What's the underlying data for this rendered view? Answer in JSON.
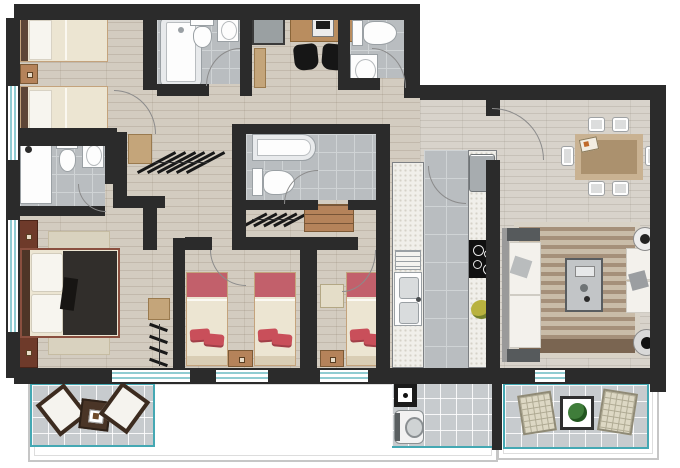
{
  "meta": {
    "title": "apartment-floor-plan",
    "canvas_w": 680,
    "canvas_h": 468
  },
  "palette": {
    "wall": "#2b2b2b",
    "wood": "#d3ccc0",
    "woodRight": "#d8d3cb",
    "tile": "#b9bdc0",
    "tileLine": "#cfd3d5",
    "shaft": "#9aa0a2",
    "balconyTile": "#c7cbce",
    "teal": "#44a8b3",
    "terrace": "#ffffff",
    "terraceEdge": "#c6c6c6",
    "fixtureWhite": "#fdfdfd",
    "fixtureEdge": "#9aa0a4",
    "counter": "#f0efea",
    "counterDot": "#d5d2c8",
    "appliance": "#a7acaf",
    "cooktop": "#101010",
    "bedCream": "#ece5d2",
    "bedFrame": "#c4a37c",
    "pillowWhite": "#f7f5ef",
    "headboardDark": "#5d4536",
    "pinkHeadboard": "#c2606b",
    "redBlanket": "#c94f5a",
    "duvetDark": "#312e2b",
    "mahogany": "#6e3a2a",
    "rugBeige": "#d9d2bf",
    "rugStripeA": "#a5907a",
    "rugStripeB": "#c9bca8",
    "rugDark": "#7a6551",
    "rugEdge": "#d8d2c6",
    "sofaWhite": "#f3f1ec",
    "sofaGrey": "#565a5c",
    "sofaBack": "#9a9a9a",
    "woodDesk": "#b98d5f",
    "woodShelf": "#c4a57a",
    "woodDresser": "#b5835a",
    "chairBlack": "#161616",
    "diningTable": "#c9b292",
    "diningTop": "#ab916e",
    "chairGrey": "#dcdddd",
    "chairEdge": "#9fa2a4",
    "wicker": "#ddd8c4",
    "wickerLine": "#b0ab94",
    "plant": "#3f7d3a",
    "bowl": "#b9b23f",
    "doorArc": "#8b8b8b",
    "glass": "#8fccd2"
  },
  "inventory": {
    "rooms": [
      "twin-bedroom",
      "bathroom-with-tub",
      "study-nook",
      "guest-bathroom",
      "ensuite-bathroom",
      "walk-in-closet",
      "master-bedroom",
      "kids-bedroom-1",
      "kids-bedroom-2",
      "central-bathroom",
      "galley-kitchen",
      "dining-room",
      "living-room",
      "master-balcony-patio",
      "service-balcony-laundry",
      "living-balcony",
      "terrace"
    ],
    "fixtures": [
      "bathtub",
      "shower",
      "toilet-x4",
      "washbasin-x4",
      "kitchen-sink",
      "cooktop-4-burner",
      "fridge",
      "washing-machine",
      "laundry-sink"
    ],
    "furniture": [
      "twin-bed-x2-cream",
      "single-bed-x3-pink",
      "double-bed-dark-duvet",
      "nightstand-x6",
      "desk-with-laptop",
      "desk-chair-x2",
      "clothes-rack-x3",
      "dresser",
      "dining-table-6-chairs",
      "sofa-x2-white",
      "coffee-table",
      "round-side-table-x2",
      "area-rug-striped",
      "patio-chair-x4",
      "patio-table-x2"
    ]
  }
}
